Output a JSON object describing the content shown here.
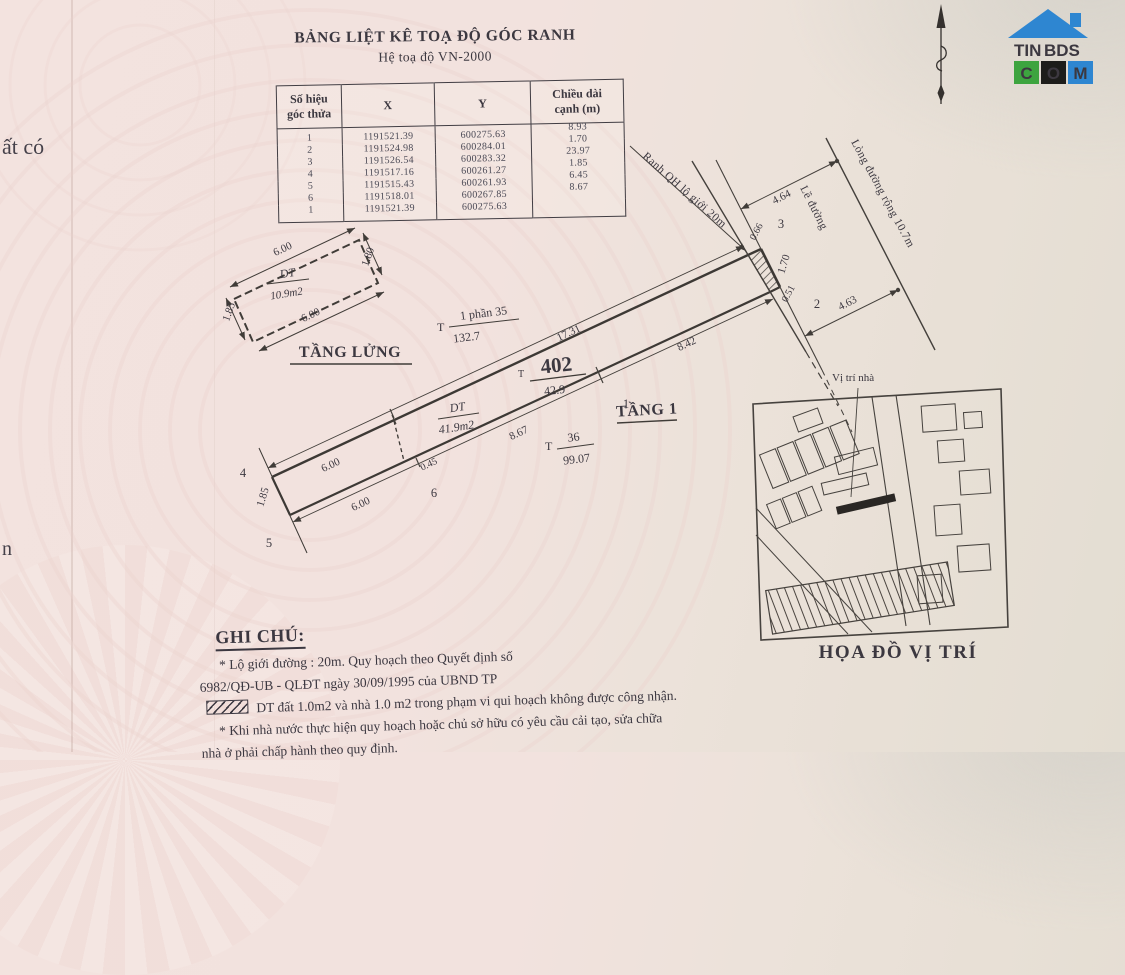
{
  "document": {
    "title": "BẢNG LIỆT KÊ TOẠ ĐỘ GÓC RANH",
    "subtitle": "Hệ toạ độ VN-2000"
  },
  "coordinate_table": {
    "headers": {
      "corner_line1": "Số hiệu",
      "corner_line2": "góc thửa",
      "x": "X",
      "y": "Y",
      "length_line1": "Chiều dài",
      "length_line2": "cạnh (m)"
    },
    "rows": [
      {
        "id": "1",
        "x": "1191521.39",
        "y": "600275.63",
        "len": "8.93"
      },
      {
        "id": "2",
        "x": "1191524.98",
        "y": "600284.01",
        "len": "1.70"
      },
      {
        "id": "3",
        "x": "1191526.54",
        "y": "600283.32",
        "len": "23.97"
      },
      {
        "id": "4",
        "x": "1191517.16",
        "y": "600261.27",
        "len": "1.85"
      },
      {
        "id": "5",
        "x": "1191515.43",
        "y": "600261.93",
        "len": "6.45"
      },
      {
        "id": "6",
        "x": "1191518.01",
        "y": "600267.85",
        "len": "8.67"
      },
      {
        "id": "1",
        "x": "1191521.39",
        "y": "600275.63",
        "len": ""
      }
    ]
  },
  "drawing": {
    "mezzanine": {
      "label": "TẦNG LỬNG",
      "area_label": "DT",
      "area_value": "10.9m2",
      "dim_top": "6.00",
      "dim_bottom": "6.00",
      "dim_right": "1.80",
      "dim_left": "1.85"
    },
    "parcel": {
      "floor_label": "TẦNG 1",
      "thua_prefix": "T",
      "number": "402",
      "area": "42.9",
      "house_area_label": "DT",
      "house_area_value": "41.9m2"
    },
    "neighbor_upper": {
      "prefix": "T",
      "numerator": "1 phần 35",
      "denominator": "132.7"
    },
    "neighbor_lower": {
      "prefix": "T",
      "numerator": "36",
      "denominator": "99.07"
    },
    "dims": {
      "top_left": "6.00",
      "top_main": "17.31",
      "top_end": "0.66",
      "end_right": "1.70",
      "end_bottom": "0.51",
      "street_upper": "4.64",
      "street_lower": "4.63",
      "bottom_street": "8.42",
      "bottom_mid": "8.67",
      "bottom_small": "0.45",
      "bottom_left": "6.00",
      "left_edge": "1.85"
    },
    "points": {
      "p1": "1",
      "p2": "2",
      "p3": "3",
      "p4": "4",
      "p5": "5",
      "p6": "6"
    },
    "streets": {
      "ranh_qh": "Ranh QH lộ giới 20m",
      "le_duong": "Lề đường",
      "long_duong": "Lòng đường rộng 10.7m"
    }
  },
  "location_map": {
    "pointer_label": "Vị trí nhà",
    "caption": "HỌA ĐỒ VỊ TRÍ"
  },
  "notes": {
    "heading": "GHI CHÚ:",
    "line1": "* Lộ giới đường : 20m. Quy hoạch theo Quyết định số",
    "line2": "6982/QĐ-UB - QLĐT ngày 30/09/1995 của UBND TP",
    "line3": "DT đất  1.0m2  và nhà  1.0 m2  trong phạm vi qui hoạch không được công nhận.",
    "line4": "* Khi nhà nước thực hiện quy hoạch hoặc chủ sở hữu có yêu cầu cải tạo, sửa chữa",
    "line5": "nhà ở phải chấp hành theo quy định."
  },
  "logo": {
    "brand_part1": "TIN",
    "brand_part2": "BDS",
    "letter_c": "C",
    "letter_o": "O",
    "letter_m": "M"
  },
  "page_fragments": {
    "left_top": "ất có",
    "left_bottom": "n"
  },
  "colors": {
    "logo_blue": "#2e86d1",
    "logo_green": "#3da43f",
    "logo_dark": "#1d1d1b",
    "ink": "#3c3840"
  }
}
